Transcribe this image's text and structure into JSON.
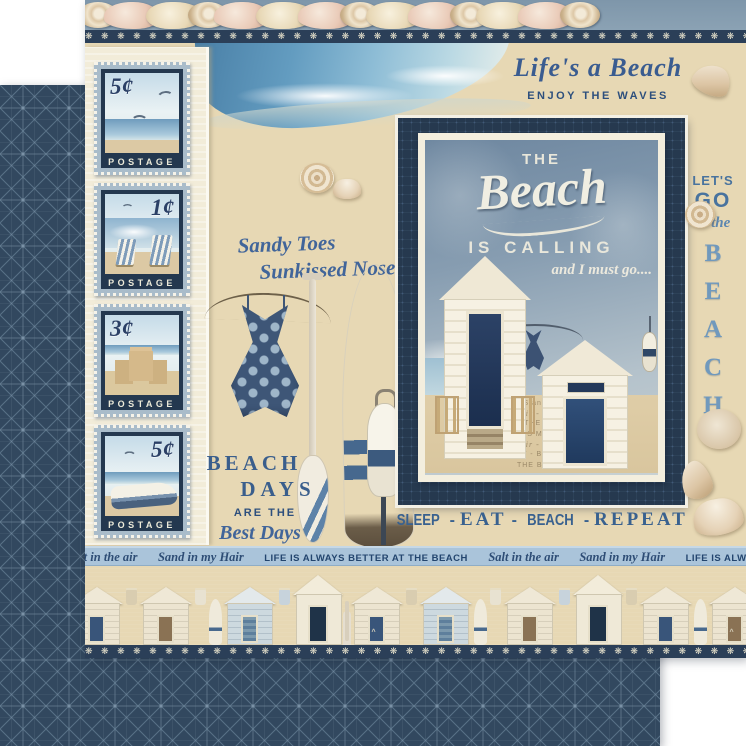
{
  "header": {
    "script": "Life's a Beach",
    "caps": "ENJOY THE WAVES"
  },
  "stamps": [
    {
      "value": "5¢",
      "label": "POSTAGE",
      "scene": "seagulls over surf"
    },
    {
      "value": "1¢",
      "label": "POSTAGE",
      "scene": "beach chairs on shore"
    },
    {
      "value": "3¢",
      "label": "POSTAGE",
      "scene": "sandcastle"
    },
    {
      "value": "5¢",
      "label": "POSTAGE",
      "scene": "rowboat on beach"
    }
  ],
  "left": {
    "sandy1": "Sandy Toes",
    "sandy2": "Sunkissed Nose",
    "bd1": "BEACH",
    "bd2": "DAYS",
    "are": "ARE THE",
    "best": "Best Days"
  },
  "poster": {
    "kicker": "THE",
    "title": "Beach",
    "calling": "IS CALLING",
    "mustgo": "and I must go....",
    "faint": [
      "THE BEACH",
      "HIGH TIDES and GOOD VIBES",
      "TO THE BEACH",
      "THE BEACH IS MY HAPPY PLACE",
      "Salt in the air - Sand in my hair",
      "SLEEP - EAT - BEACH - REPEAT"
    ]
  },
  "right": {
    "lets": "LET'S",
    "go": "GO",
    "tothe": "to the",
    "letters": [
      "B",
      "E",
      "A",
      "C",
      "H"
    ]
  },
  "motto": {
    "w1": "SLEEP",
    "w2": "EAT",
    "w3": "BEACH",
    "w4": "REPEAT",
    "sep": "-"
  },
  "strip": {
    "salt": "Salt in the air",
    "sand": "Sand in my Hair",
    "life": "LIFE IS ALWAYS BETTER AT THE BEACH"
  },
  "ornaments": {
    "shell_glyphs": "❋ ❋ ❋ ❋ ❋ ❋ ❋ ❋ ❋ ❋ ❋ ❋ ❋ ❋ ❋ ❋ ❋ ❋ ❋ ❋ ❋ ❋ ❋ ❋ ❋ ❋ ❋ ❋ ❋ ❋ ❋ ❋ ❋ ❋ ❋ ❋ ❋ ❋ ❋ ❋ ❋ ❋ ❋ ❋ ❋ ❋ ❋ ❋",
    "chevron": "^"
  },
  "colors": {
    "navy": "#2c4158",
    "sand": "#e5d4ac",
    "sky_blue": "#7fb0d0",
    "strip_blue": "#aac4da",
    "text_blue": "#3a5e8c",
    "cream": "#f2ecd9"
  }
}
